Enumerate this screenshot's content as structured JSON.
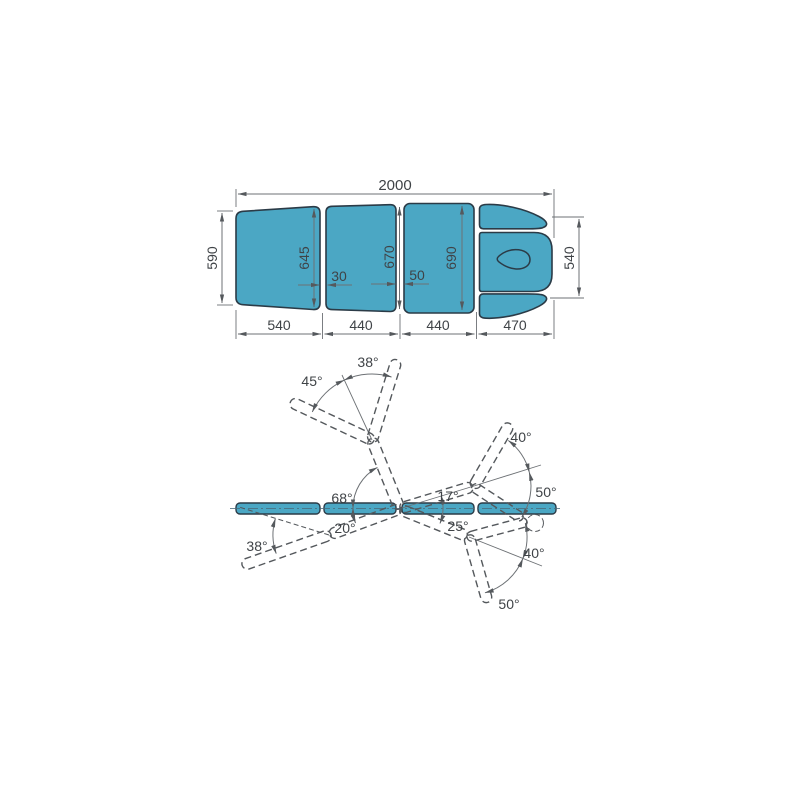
{
  "colors": {
    "upholstery": "#4BA7C4",
    "outline": "#2B3B47",
    "dimension_line": "#6d7175",
    "dashed_line": "#54585c",
    "text": "#3f4347"
  },
  "top_view": {
    "overall_length": "2000",
    "height_left": "590",
    "height_section1_right": "645",
    "height_section2_right": "670",
    "height_section3": "690",
    "height_headrest": "540",
    "gap_1": "30",
    "gap_2": "50",
    "width_section1": "540",
    "width_section2": "440",
    "width_section3": "440",
    "width_section4": "470"
  },
  "side_view": {
    "headrest_up_angle": "38°",
    "headrest_back_angle": "45°",
    "leg_up_angle_raised": "40°",
    "leg_down_angle_raised": "50°",
    "seat_up_angle": "17°",
    "backrest_up_angle": "68°",
    "backrest_down_angle": "20°",
    "seat_down_angle": "25°",
    "headrest_down_angle": "38°",
    "leg_up_angle_lowered": "40°",
    "leg_down_angle_lowered": "50°"
  }
}
